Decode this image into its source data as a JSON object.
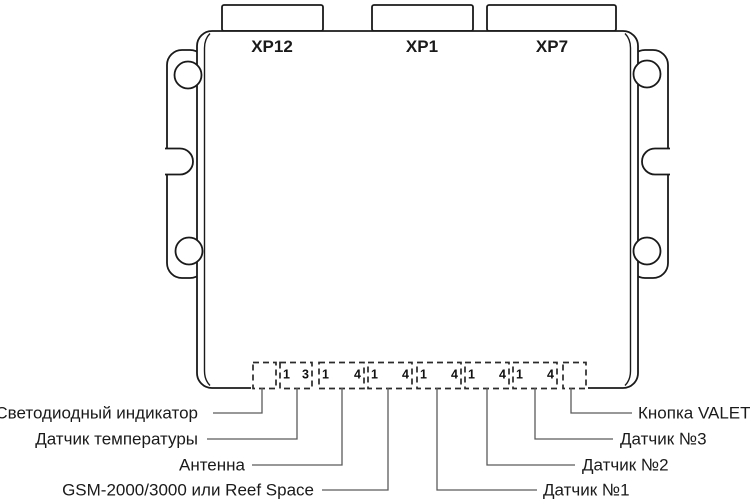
{
  "device": {
    "top_connectors": [
      {
        "label": "XP12"
      },
      {
        "label": "XP1"
      },
      {
        "label": "XP7"
      }
    ],
    "pin_rows": [
      {
        "name": "led-indicator",
        "first": "",
        "last": ""
      },
      {
        "name": "temperature-sensor",
        "first": "1",
        "last": "3"
      },
      {
        "name": "antenna",
        "first": "1",
        "last": "4"
      },
      {
        "name": "gsm-module",
        "first": "1",
        "last": "4"
      },
      {
        "name": "sensor-1",
        "first": "1",
        "last": "4"
      },
      {
        "name": "sensor-2",
        "first": "1",
        "last": "4"
      },
      {
        "name": "sensor-3",
        "first": "1",
        "last": "4"
      },
      {
        "name": "valet-button",
        "first": "",
        "last": ""
      }
    ],
    "callouts_left": [
      {
        "label": "Светодиодный индикатор"
      },
      {
        "label": "Датчик температуры"
      },
      {
        "label": "Антенна"
      },
      {
        "label": "GSM-2000/3000 или Reef Space"
      }
    ],
    "callouts_right": [
      {
        "label": "Кнопка VALET"
      },
      {
        "label": "Датчик №3"
      },
      {
        "label": "Датчик №2"
      },
      {
        "label": "Датчик №1"
      }
    ]
  },
  "colors": {
    "line": "#1a1a1a",
    "leader": "#5a5a5a",
    "background": "#ffffff"
  }
}
